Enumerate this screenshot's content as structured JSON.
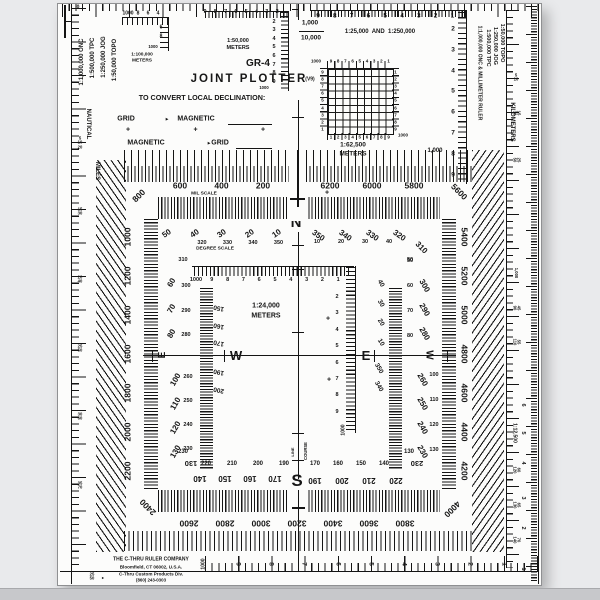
{
  "device": {
    "model": "GR-4",
    "title": "JOINT PLOTTER",
    "version": "(V9)"
  },
  "icons": {
    "arrow_right": "▸"
  },
  "declination": {
    "heading": "TO CONVERT LOCAL DECLINATION:",
    "rows": [
      {
        "from": "GRID",
        "to": "MAGNETIC"
      },
      {
        "from": "MAGNETIC",
        "to": "GRID"
      }
    ],
    "plus_marks": [
      "+",
      "+",
      "+"
    ]
  },
  "top_left_scales": [
    "1:1,000,000 ONC",
    "1:500,000 TPC",
    "1:250,000 JOG",
    "1:50,000 TOPO"
  ],
  "left_edge": {
    "zero": "0",
    "label_top": "NAUTICAL",
    "label_bottom": "MILES",
    "pairs": [
      "5\n10\n20",
      "15\n30",
      "20\n40",
      "25\n50",
      "30\n60",
      "35\n70"
    ],
    "bottom_pair": "25\n50"
  },
  "right_edge": {
    "scales": [
      "1:50,000 TOPO",
      "1:250,000 JOG",
      "1:500,000 TPC",
      "1:1,000,000 ONC & MILLIMETER RULER"
    ],
    "kilometers_label": "KILOMETERS",
    "ruler_scale": "1:12,500",
    "pairs": [
      "5\n10",
      "15\n30",
      "25\n50",
      "1,000",
      "45\n90",
      "55\n110",
      "60\n120",
      "65\n130",
      "70\n140"
    ],
    "cm_numbers": [
      "6",
      "5",
      "4",
      "3",
      "2",
      "1"
    ]
  },
  "ruler_100k": {
    "label": [
      "1:100,000",
      "METERS"
    ],
    "h": [
      "1000",
      "8",
      "6",
      "4"
    ],
    "v": [
      "6",
      "8"
    ],
    "v_end": "1000"
  },
  "ruler_50k": {
    "label": [
      "1:50,000",
      "METERS"
    ],
    "h": [
      "9",
      "8",
      "7",
      "6",
      "5",
      "4",
      "3",
      "2"
    ],
    "v": [
      "2",
      "3",
      "4",
      "5",
      "6",
      "7",
      "8",
      "9"
    ],
    "v_end": "1000"
  },
  "ruler_25k": {
    "label": "1:25,000  AND  1:250,000",
    "numerator": "1,000",
    "denominator": "10,000",
    "h": [
      "9",
      "8",
      "7",
      "6",
      "5",
      "4",
      "3",
      "2",
      "1"
    ],
    "v": [
      "2",
      "3",
      "4",
      "5",
      "6",
      "7",
      "8",
      "9"
    ],
    "v_end": "1,000"
  },
  "grid_62500": {
    "label": [
      "1:62,500",
      "METERS"
    ],
    "corner_tl": "1000",
    "corner_br": "1000",
    "top": [
      "9",
      "8",
      "7",
      "6",
      "5",
      "4",
      "3",
      "2",
      "1"
    ],
    "left": [
      "9",
      "8",
      "7",
      "6",
      "5",
      "4",
      "3",
      "2",
      "1"
    ],
    "right": [
      "1",
      "2",
      "3",
      "4",
      "5",
      "6",
      "7",
      "8",
      "9"
    ],
    "bottom": [
      "1",
      "2",
      "3",
      "4",
      "5",
      "6",
      "7",
      "8",
      "9"
    ]
  },
  "ruler_24k": {
    "label": [
      "1:24,000",
      "METERS"
    ],
    "h": [
      "1000",
      "9",
      "8",
      "7",
      "6",
      "5",
      "4",
      "3",
      "2",
      "1"
    ],
    "v": [
      "2",
      "3",
      "4",
      "5",
      "6",
      "7",
      "8",
      "9"
    ],
    "v_end": "1000"
  },
  "mil_scale": {
    "label": "MIL SCALE",
    "top_left": [
      "600",
      "400",
      "200"
    ],
    "top_right": [
      "6200",
      "6000",
      "5800"
    ],
    "left": [
      "1000",
      "1200",
      "1400",
      "1600",
      "1800",
      "2000",
      "2200"
    ],
    "right": [
      "5400",
      "5200",
      "5000",
      "4800",
      "4600",
      "4400",
      "4200"
    ],
    "bottom": [
      "2600",
      "2800",
      "3000",
      "3200",
      "3400",
      "3600",
      "3800"
    ],
    "corner_tl": "800",
    "corner_tr": "5600",
    "corner_bl": "2400",
    "corner_br": "4000"
  },
  "degree_scale": {
    "label": "DEGREE SCALE",
    "top_left_large": [
      "50",
      "40",
      "30",
      "20",
      "10"
    ],
    "top_left_small": [
      "320",
      "330",
      "340",
      "350"
    ],
    "top_right_large": [
      "350",
      "340",
      "330",
      "320"
    ],
    "top_right_small": [
      "10",
      "20",
      "30",
      "40"
    ],
    "corner_tl_small": "310",
    "corner_tr_large": "310",
    "corner_tr_small": "50",
    "left_upper_large": [
      "60",
      "70",
      "80"
    ],
    "left_upper_small": [
      "300",
      "290",
      "280"
    ],
    "left_lower_large": [
      "100",
      "110",
      "120",
      "130"
    ],
    "left_lower_small": [
      "260",
      "250",
      "240",
      "230"
    ],
    "right_upper_large": [
      "300",
      "290",
      "280"
    ],
    "right_upper_small": [
      "50",
      "60",
      "70",
      "80"
    ],
    "right_lower_large": [
      "260",
      "250",
      "240",
      "230"
    ],
    "right_lower_small": [
      "100",
      "110",
      "120",
      "130"
    ],
    "bottom_left_upright": [
      "220",
      "210",
      "200",
      "190"
    ],
    "bottom_right_upright": [
      "170",
      "160",
      "150",
      "140"
    ],
    "bottom_left_inverted": [
      "140",
      "150",
      "160",
      "170"
    ],
    "bottom_right_inverted": [
      "190",
      "200",
      "210",
      "220"
    ],
    "corner_bl_upright": "230",
    "corner_bl_inverted": "130",
    "corner_br_upright": "130",
    "corner_br_inverted": "230"
  },
  "course_ring": {
    "course_label": "COURSE",
    "line_label": "LINE",
    "left_upper": [
      "150",
      "160",
      "170"
    ],
    "left_lower": [
      "190",
      "200"
    ],
    "right_upper": [
      "40",
      "30",
      "20",
      "10"
    ],
    "right_lower": [
      "350",
      "340"
    ]
  },
  "cardinals": {
    "north": "N",
    "south": "S",
    "east_inner": "E",
    "west_inner": "W",
    "east_side": "E",
    "west_side": "W"
  },
  "registration": {
    "marks": [
      "+",
      "+",
      "+"
    ]
  },
  "bottom_ruler": {
    "label": "1000",
    "numbers": [
      "9",
      "8",
      "7",
      "6",
      "5",
      "4",
      "3",
      "2",
      "1"
    ]
  },
  "company": {
    "name": "THE C-THRU RULER COMPANY",
    "address": "Bloomfield, CT 06002, U.S.A.",
    "division": "C-Thru Custom Products Div.",
    "phone": "(860) 243-0303"
  }
}
